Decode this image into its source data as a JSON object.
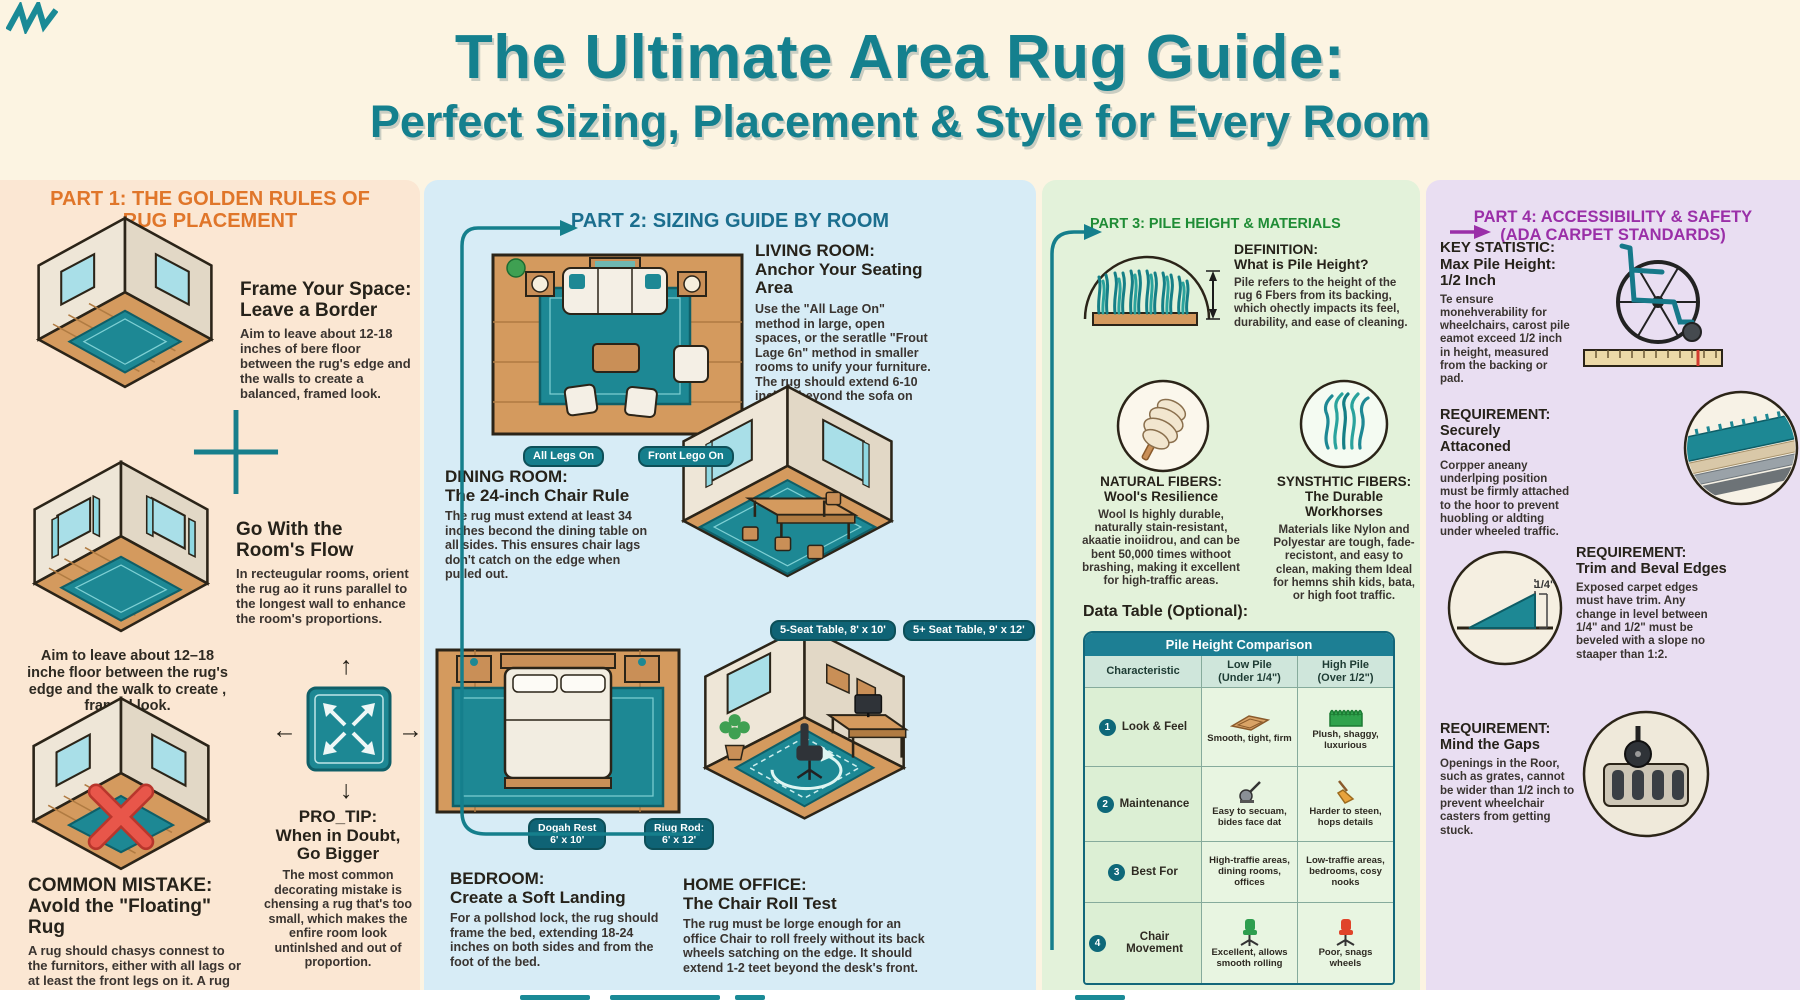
{
  "title": {
    "line1": "The Ultimate Area Rug Guide:",
    "line2": "Perfect Sizing, Placement & Style for Every Room"
  },
  "part1": {
    "header": "PART 1: THE GOLDEN RULES OF\nRUG PLACEMENT",
    "rule1": {
      "title": "Frame Your Space:\nLeave a Border",
      "body": "Aim to leave about 12-18 inches of bere floor between the rug's edge and the walls to create a balanced, framed look."
    },
    "rule2": {
      "title": "Go With the Room's Flow",
      "body": "In recteugular rooms, orient the rug ao it runs parallel to the longest wall to en­hance the room's proportions."
    },
    "caption": "Aim to leave about 12–18 inche floor between the rug's edge and the walk to create , framed look.",
    "mistake": {
      "title": "COMMON MISTAKE:\nAvold the \"Floating\" Rug",
      "body": "A rug should chasys connest to the furnitors, either with all lags or at least the front legs on it. A rug Isolsted is the middle makes the space feel disconnected."
    },
    "protip": {
      "title": "PRO_TIP:\nWhen in Doubt,\nGo Bigger",
      "body": "The most common decorating mistake is chensing a rug that's too small, which makes the enfire room look untinlshed and out of proportion."
    }
  },
  "part2": {
    "header": "PART 2: SIZING GUIDE BY ROOM",
    "living": {
      "title": "LIVING ROOM:\nAnchor Your Seating Area",
      "body": "Use the \"All Lage On\" method in large, open spaces, or the seratlle \"Frout Lage 6n\" method in smaller rooms to unify your furniture. The rug should extend 6-10 inches beyond the sofa on each side."
    },
    "labels": {
      "all_legs": "All Legs On",
      "front_legs": "Front Lego On",
      "five_seat": "5-Seat Table, 8' x 10'",
      "five_plus_seat": "5+ Seat Table, 9' x 12'",
      "bed_left": "Dogah Rest\n6' x 10'",
      "bed_right": "Riug Rod:\n6' x 12'"
    },
    "dining": {
      "title": "DINING ROOM:\nThe 24-inch Chair Rule",
      "body": "The rug must extend at least 34 inches becond the dining table on all sides. This ensures chair lags don't catch on the edge when pulled out."
    },
    "bedroom": {
      "title": "BEDROOM:\nCreate a Soft Landing",
      "body": "For a pollshod lock, the rug should frame the bed, extending 18-24 inches on both sides and from the foot of the bed."
    },
    "office": {
      "title": "HOME OFFICE:\nThe Chair Roll Test",
      "body": "The rug must be lorge enough for an office Chair to roll freely without its back wheels satching on the edge. It should extend 1-2 teet beyond the desk's front."
    }
  },
  "part3": {
    "header": "PART 3: PILE HEIGHT & MATERIALS",
    "definition": {
      "title": "DEFINITION:\nWhat is Pile Height?",
      "body": "Pile refers to the height of the rug 6 Fbers from its backing, which ohectly impacts its feel, durability, and ease of cleaning."
    },
    "natural": {
      "title": "NATURAL FIBERS:\nWool's Resilience",
      "body": "Wool Is highly durable, naturally stain-resistant, akaatie inoiidrou, and can be bent 50,000 times withoot brashing, making it excellent for high-traffic areas."
    },
    "synthetic": {
      "title": "SYNSTHTIC FIBERS:\nThe Durable Workhorses",
      "body": "Materials like Nylon and Polyestar are tough, fade-recistont, and easy to clean, making them Ideal for hemns shih kids, bata, or high foot traffic."
    },
    "table_label": "Data Table (Optional):",
    "table": {
      "title": "Pile Height Comparison",
      "columns": [
        "Characteristic",
        "Low Pile\n(Under 1/4\")",
        "High Pile\n(Over 1/2\")"
      ],
      "rows": [
        {
          "num": "1",
          "name": "Look & Feel",
          "low": "Smooth, tight, firm",
          "high": "Plush, shaggy, luxurious"
        },
        {
          "num": "2",
          "name": "Maintenance",
          "low": "Easy to secuam, bides face dat",
          "high": "Harder to steen, hops details"
        },
        {
          "num": "3",
          "name": "Best For",
          "low": "High-traffie areas, dining rooms, offices",
          "high": "Low-traffie areas, bedrooms, cosy nooks"
        },
        {
          "num": "4",
          "name": "Chair Movement",
          "low": "Excellent, allows smooth rolling",
          "high": "Poor, snags wheels"
        }
      ]
    }
  },
  "part4": {
    "header": "PART 4: ACCESSIBILITY & SAFETY\n(ADA CARPET STANDARDS)",
    "stat": {
      "title": "KEY STATISTIC:\nMax Pile Height:\n1/2 Inch",
      "body": "Te ensure monehverability for wheelchairs, carost pile eamot exceed 1/2 inch in height, measured from the backing or pad."
    },
    "req1": {
      "title": "REQUIREMENT:\nSecurely Attaconed",
      "body": "Corpper aneany underlping position must be firmly attached to the hoor to prevent huobling or aldting under wheeled traffic."
    },
    "req2": {
      "title": "REQUIREMENT:\nTrim and Beval Edges",
      "body": "Exposed carpet edges must have trim. Any change in level between 1/4\" and 1/2\" must be beveled with a slope no staaper than 1:2.",
      "annotation": "1/4\""
    },
    "req3": {
      "title": "REQUIREMENT:\nMind the Gaps",
      "body": "Openings in the Roor, such as grates, cannot be wider than 1/2 inch to prevent wheelchair casters from getting stuck."
    }
  },
  "colors": {
    "teal_title": "#14808E",
    "orange_header": "#E0762A",
    "blue_header": "#1B6E8E",
    "green_header": "#1F8C35",
    "purple_header": "#9A2FA8",
    "rug_teal": "#1D8894",
    "wood": "#D49A5E",
    "table_header": "#1D7F94"
  }
}
